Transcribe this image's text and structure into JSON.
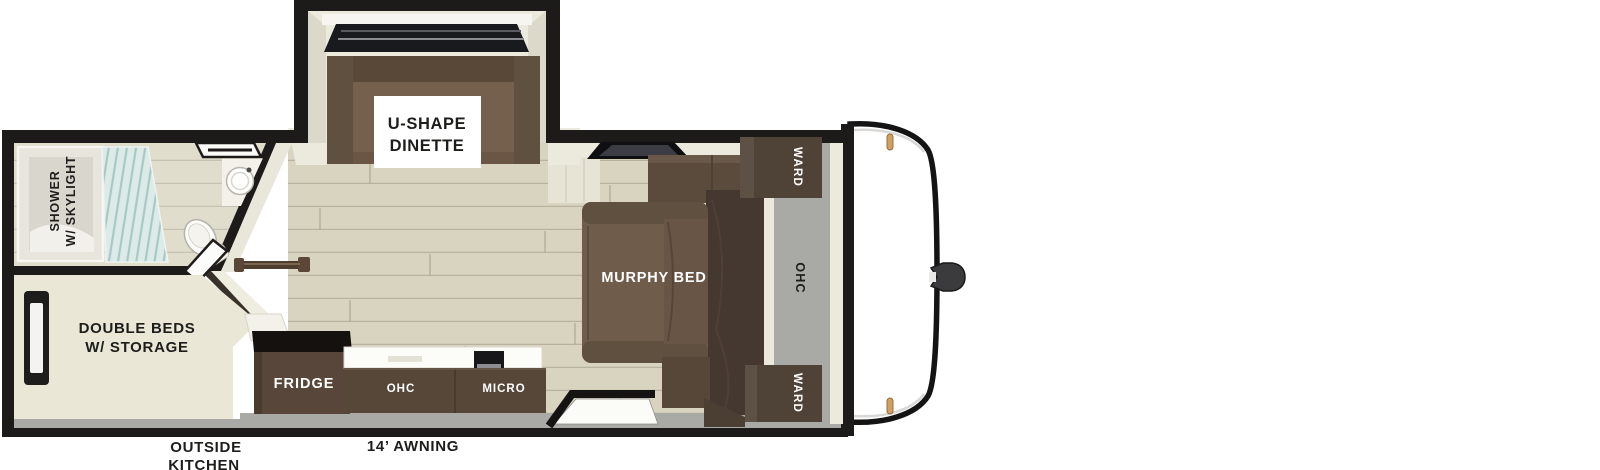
{
  "page": {
    "type": "travel-trailer-floorplan",
    "background": "#ffffff"
  },
  "colors": {
    "wall": "#1d1b19",
    "wood_floor": "#d8d4bf",
    "plank_line": "#b7b39f",
    "interior_cream": "#ece9dd",
    "gray_zone": "#a9a9a5",
    "sofa_brown": "#6f5c4a",
    "sofa_brown_dark": "#60503f",
    "cabinet_brown": "#564739",
    "murphy_slab": "#443830",
    "glass_teal": "#dcebe8",
    "clearance_light_amber": "#cf9f63",
    "text_dark": "#1d1d1b",
    "text_white": "#ffffff"
  },
  "floorplan": {
    "slideout_dinette": {
      "label_lines": [
        "U-SHAPE",
        "DINETTE"
      ]
    },
    "bathroom": {
      "shower_label_lines": [
        "SHOWER",
        "W/ SKYLIGHT"
      ]
    },
    "rear_bedroom": {
      "label_lines": [
        "DOUBLE BEDS",
        "W/ STORAGE"
      ]
    },
    "living_area": {
      "murphy_bed_label": "MURPHY BED",
      "ward_top_label": "WARD",
      "ward_bottom_label": "WARD",
      "overhead_cabinet_label": "OHC"
    },
    "kitchen": {
      "fridge_label": "FRIDGE",
      "overhead_cabinet_label": "OHC",
      "microwave_label": "MICRO"
    },
    "exterior": {
      "outside_kitchen_label_lines": [
        "OUTSIDE",
        "KITCHEN"
      ],
      "awning_label": "14’ AWNING"
    }
  }
}
